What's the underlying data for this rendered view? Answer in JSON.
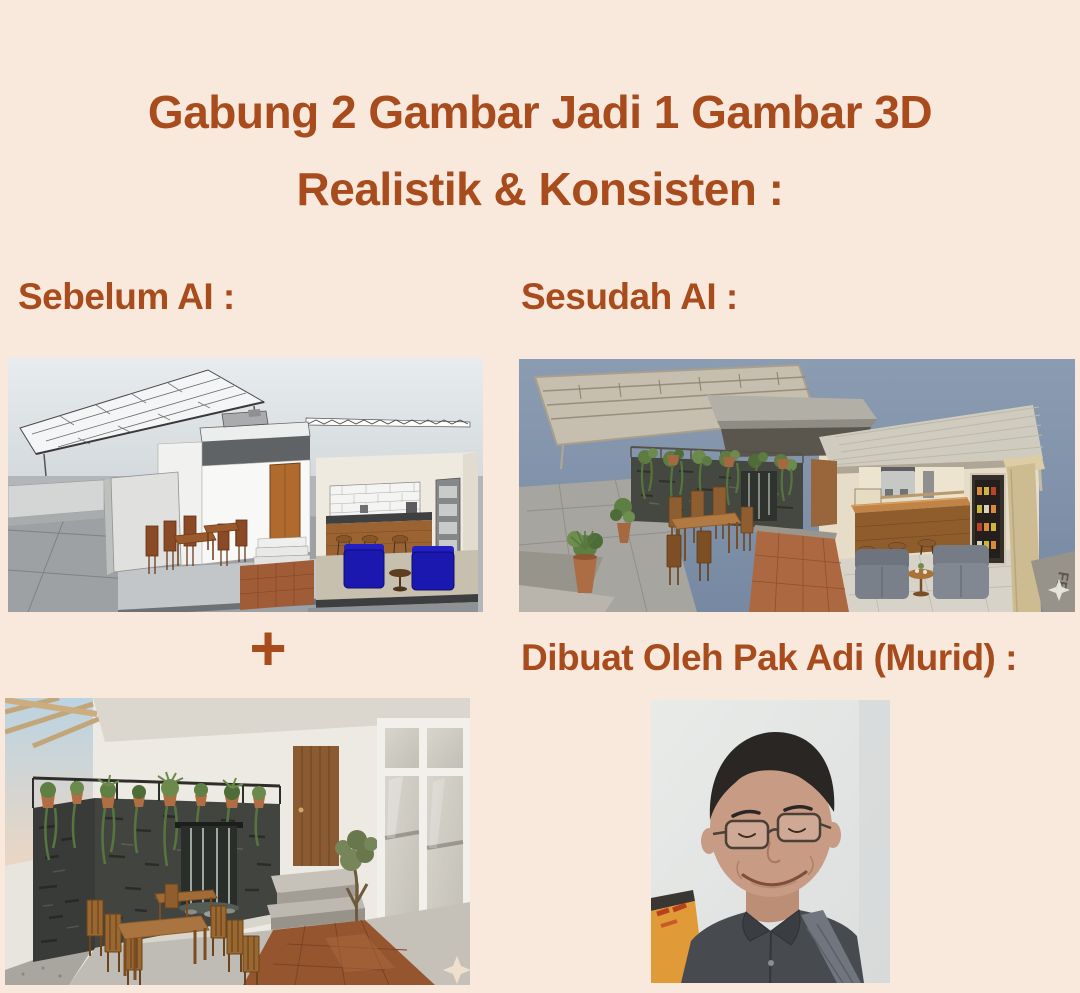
{
  "page": {
    "background_color": "#F8E9DC",
    "accent_color": "#A84B1D"
  },
  "title": {
    "line1": "Gabung 2 Gambar Jadi 1 Gambar 3D",
    "line2": "Realistik & Konsisten :"
  },
  "labels": {
    "before": "Sebelum AI :",
    "after": "Sesudah AI :",
    "plus": "+",
    "creator": "Dibuat Oleh Pak Adi (Murid) :"
  },
  "images": {
    "before_sketch": {
      "description": "SketchUp-style 3D massing sketch of a small cafe: white canopy truss roof, white walls, wooden door with steps, outdoor wooden tables and chairs, bar counter with white brick backsplash, bar stools and two blue armchairs"
    },
    "after_render": {
      "description": "Photorealistic AI render of the same cafe: metal canopy roofs over a dark stone feature wall with hanging plants, wooden dining set, timber bar with coffee machines, drinks fridge and two grey armchairs on a terracotta path",
      "floor_text": "FE"
    },
    "reference_photo": {
      "description": "Realistic outdoor cafe seating reference: dark stacked-stone wall with waterfall feature, terracotta pots with trailing plants on a metal frame, wooden dining tables and chairs, timber door with steps, potted olive tree, glazed white doors and wet terracotta floor"
    },
    "creator_photo": {
      "description": "Portrait photo of Pak Adi: smiling man with glasses and dark hair wearing a dark grey collared shirt with a bag strap"
    }
  }
}
